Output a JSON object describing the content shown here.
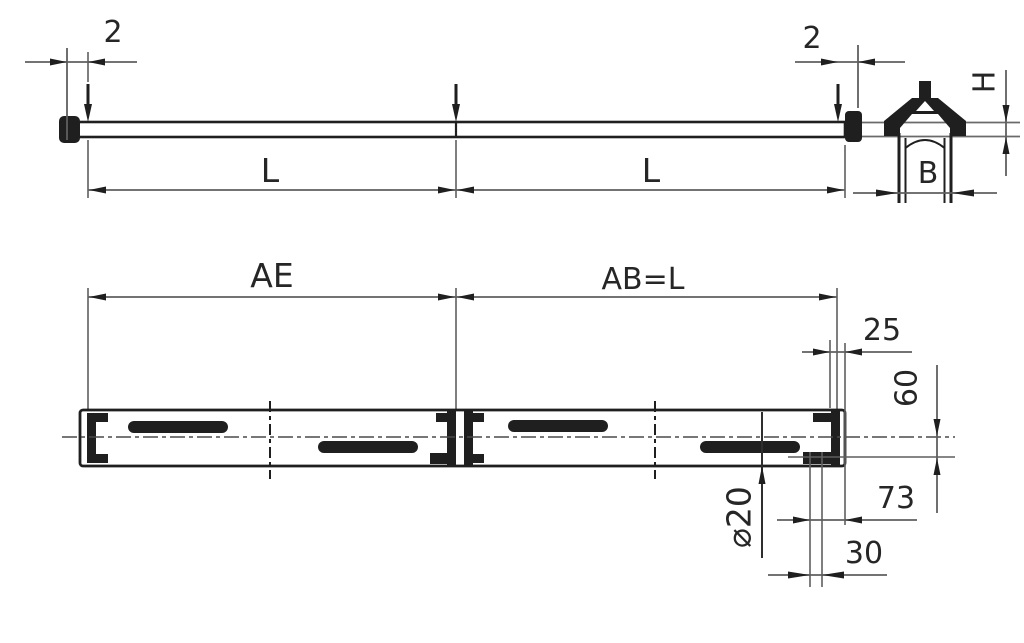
{
  "drawing": {
    "type": "technical-dimension-drawing",
    "colors": {
      "background": "#ffffff",
      "object_line": "#1f1f1f",
      "thin_line": "#5f5f5f",
      "text": "#262626"
    },
    "side_view": {
      "gap_left": "2",
      "gap_right": "2",
      "length_left": "L",
      "length_right": "L"
    },
    "cross_section": {
      "height": "H",
      "width": "B"
    },
    "plan_view": {
      "span_left": "AE",
      "span_right": "AB=L",
      "end_offset": "25",
      "width": "60",
      "edge_distance": "73",
      "pitch": "30",
      "hole_diameter": "⌀20"
    }
  }
}
